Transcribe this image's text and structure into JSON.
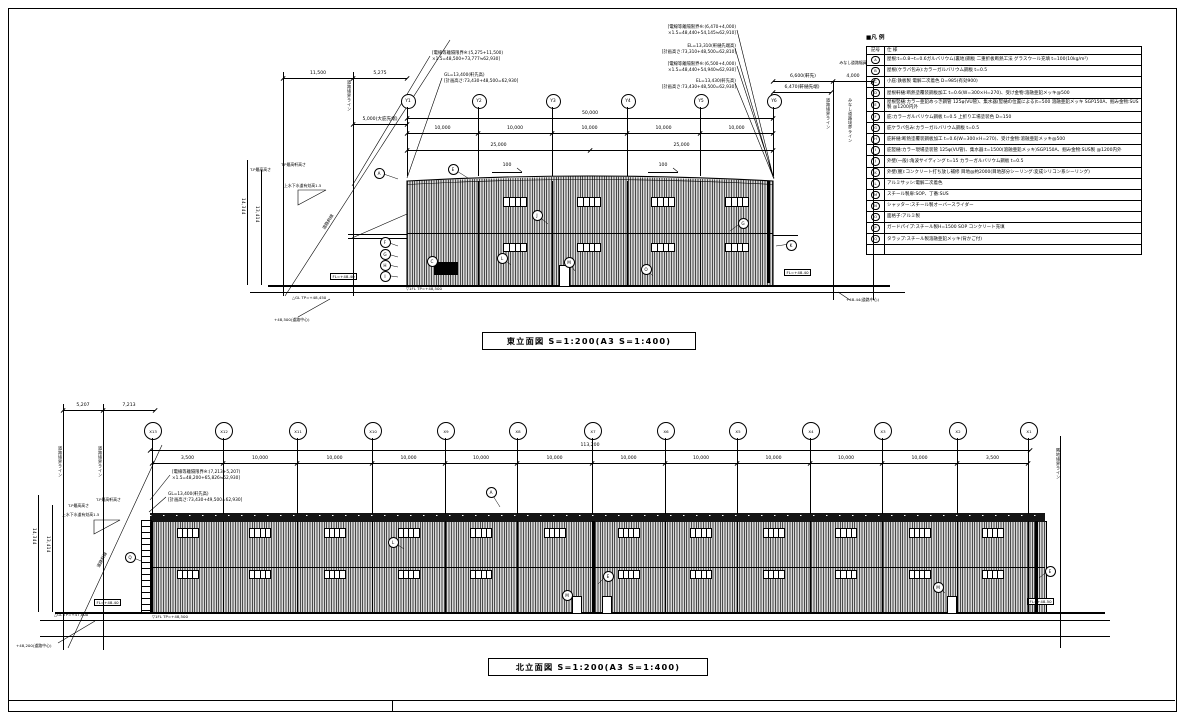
{
  "legend": {
    "title": "■凡 例",
    "col_symbol": "記号",
    "col_spec": "仕  様",
    "rows": [
      {
        "sym": "A",
        "spec": "屋根:t=0.8~t=0.6ガルバリウム(裏地)鋼板 二重折板断熱工法 グラスウール充填 t=100(10kg/m²)"
      },
      {
        "sym": "B",
        "spec": "屋根(ケラバ包み):カラーガルバリウム鋼板 t=0.5"
      },
      {
        "sym": "C",
        "spec": "小庇:鉄板製 電解二次着色 D=985(有効900)"
      },
      {
        "sym": "D",
        "spec": "屋根軒樋:断熱塗覆装鋼板加工 t=0.6(W=300×H=270)、受け金物:溶融亜鉛メッキ@500"
      },
      {
        "sym": "E",
        "spec": "屋根竪樋:カラー亜鉛めっき鋼管 125φ(VU管)、集水器(竪樋の位置による)t=500 溶融亜鉛メッキ SGP150A、掴み金物:SUS製 @1200内外"
      },
      {
        "sym": "F",
        "spec": "庇:カラーガルバリウム鋼板 t=0.5 上折り工場塗装色 D=150"
      },
      {
        "sym": "G",
        "spec": "庇ケラバ包み:カラーガルバリウム鋼板 t=0.5"
      },
      {
        "sym": "H",
        "spec": "庇軒樋:断熱塗覆装鋼板加工 t=0.6(W=300×H=270)、受け金物:溶融亜鉛メッキ@500"
      },
      {
        "sym": "I",
        "spec": "庇竪樋:カラー現場塗装管 125φ(VU管)、集水器:t=1500(溶融亜鉛メッキ)SGP150A、掴み金物:SUS製 @1200内外"
      },
      {
        "sym": "J",
        "spec": "外壁(一般):角波サイディング t=15 カラーガルバリウム鋼板 t=0.5"
      },
      {
        "sym": "K",
        "spec": "外壁(腰):コンクリート打ち放し補修 目地@約2000(目地部分シーリング:変成シリコン系シーリング)"
      },
      {
        "sym": "L",
        "spec": "アルミサッシ:電解二次着色"
      },
      {
        "sym": "M",
        "spec": "スチール製扉:SOP、丁番:SUS"
      },
      {
        "sym": "N",
        "spec": "シャッター:スチール製オーバースライダー"
      },
      {
        "sym": "O",
        "spec": "面格子:アルミ製"
      },
      {
        "sym": "P",
        "spec": "ガードパイプ:スチール製H=1500 SOP コンクリート充填"
      },
      {
        "sym": "Q",
        "spec": "タラップ:スチール製溶融亜鉛メッキ(背かご付)"
      }
    ]
  },
  "east": {
    "title": "東立面図  S=1:200(A3 S=1:400)",
    "grids": [
      "Y1",
      "Y2",
      "Y3",
      "Y4",
      "Y5",
      "Y6"
    ],
    "dims": {
      "overall": "50,000",
      "spans": [
        "10,000",
        "10,000",
        "10,000",
        "10,000",
        "10,000"
      ],
      "halves": [
        "25,000",
        "25,000"
      ],
      "left_offsets": [
        "11,500",
        "5,275"
      ],
      "canopy": "5,000(大庇先端)",
      "right_row1": [
        "6,600(軒先)",
        "4,000"
      ],
      "right_row2": [
        "6,470(軒樋先端)"
      ],
      "deemed_road": "みなし道路幅員",
      "height_outer": "14,344",
      "height_inner": "13,414",
      "slope_mark": "100"
    },
    "notes": {
      "left1": [
        "[電線等離隔限界※:(5,275+11,500)",
        "×1.5=48,500+73,777≒62,930]"
      ],
      "left2": [
        "GL=13,400(軒先高)",
        "[計画高さ:73,430+48,500=62,930]"
      ],
      "right1": [
        "[電線等離隔限界※:(6,470+4,000)",
        "×1.5=48,440+54,145≒62,910]"
      ],
      "right2": [
        "EL=13,310(軒樋先端高)",
        "[計画高さ:73,310+48,500=62,810]"
      ],
      "right3": [
        "[電線等離隔限界※:(6,500+4,000)",
        "×1.5=48,440+54,940≒62,930]"
      ],
      "right4": [
        "EL=13,430(軒先高)",
        "[計画高さ:73,430+48,500=62,930]"
      ]
    },
    "labels": {
      "boundary_left": "道路境界ライン",
      "boundary_right": "道路境界ライン",
      "deemed_boundary": "みなし道路境界ライン",
      "road_slope": "道路斜線",
      "tp_max": "T.P最高高さ",
      "tp_eave": "T.P最高軒高さ",
      "sewer": "上水下水道有効高1.5",
      "fl_box": "FL=+48.40",
      "fl_level": "▽1FL TP=+48,500",
      "gl": "△GL TP=+48,450",
      "road_center_left": "+48,500(道路中心)",
      "road_center_right": "+48.44(道路中心)"
    },
    "callouts": [
      {
        "letter": "A",
        "x": 378,
        "y": 172,
        "dx": 20,
        "dy": 7
      },
      {
        "letter": "E",
        "x": 452,
        "y": 168,
        "dx": 16,
        "dy": 10
      },
      {
        "letter": "J",
        "x": 536,
        "y": 214,
        "dx": 12,
        "dy": 10
      },
      {
        "letter": "G",
        "x": 742,
        "y": 222,
        "dx": -12,
        "dy": 9
      },
      {
        "letter": "L",
        "x": 501,
        "y": 257,
        "dx": 10,
        "dy": 8
      },
      {
        "letter": "C",
        "x": 431,
        "y": 260,
        "dx": 8,
        "dy": 8
      },
      {
        "letter": "M",
        "x": 568,
        "y": 261,
        "dx": 7,
        "dy": 10
      },
      {
        "letter": "O",
        "x": 645,
        "y": 268,
        "dx": 8,
        "dy": 8
      },
      {
        "letter": "K",
        "x": 790,
        "y": 244,
        "dx": -14,
        "dy": 2
      },
      {
        "letter": "F",
        "x": 384,
        "y": 241,
        "dx": 14,
        "dy": 5
      },
      {
        "letter": "G",
        "x": 384,
        "y": 253,
        "dx": 14,
        "dy": 4
      },
      {
        "letter": "H",
        "x": 384,
        "y": 264,
        "dx": 14,
        "dy": 3
      },
      {
        "letter": "I",
        "x": 384,
        "y": 275,
        "dx": 14,
        "dy": 2
      }
    ]
  },
  "north": {
    "title": "北立面図  S=1:200(A3 S=1:400)",
    "grids": [
      "X13",
      "X12",
      "X11",
      "X10",
      "X9",
      "X8",
      "X7",
      "X6",
      "X5",
      "X4",
      "X3",
      "X2",
      "X1"
    ],
    "dims": {
      "overall": "113,200",
      "spans": [
        "3,500",
        "10,000",
        "10,000",
        "10,000",
        "10,000",
        "10,000",
        "10,000",
        "10,000",
        "10,000",
        "10,000",
        "10,000",
        "3,500"
      ],
      "left_offsets": [
        "5,207",
        "7,213"
      ],
      "height_outer": "14,344",
      "height_inner": "13,414"
    },
    "notes": {
      "left1": [
        "[電線等離隔限界※:(7,213+5,207)",
        "×1.5=48,200+65,826≒52,930]"
      ],
      "left2": [
        "GL=13,400(軒先高)",
        "[計画高さ:73,430+49,500=62,930]"
      ]
    },
    "labels": {
      "boundary_left1": "道路境界ライン",
      "boundary_left2": "道路境界ライン",
      "boundary_right": "隣地境界ライン",
      "road_slope": "道路斜線",
      "tp_max": "T.P最高高さ",
      "tp_eave": "T.P最高軒高さ",
      "sewer": "上水下水道有効高1.5",
      "fl_box_left": "FL=+48.40",
      "fl_box_right": "FL=+48.50",
      "fl_level": "▽1FL TP=+48,500",
      "gl": "△GL TP=+47,800",
      "road_center": "+48,200(道路中心)"
    },
    "callouts": [
      {
        "letter": "A",
        "x": 490,
        "y": 491,
        "dx": 10,
        "dy": 16
      },
      {
        "letter": "Q",
        "x": 129,
        "y": 556,
        "dx": 12,
        "dy": 5
      },
      {
        "letter": "L",
        "x": 392,
        "y": 541,
        "dx": 12,
        "dy": 8
      },
      {
        "letter": "E",
        "x": 607,
        "y": 575,
        "dx": -9,
        "dy": 9
      },
      {
        "letter": "M",
        "x": 566,
        "y": 594,
        "dx": 8,
        "dy": 7
      },
      {
        "letter": "M",
        "x": 937,
        "y": 586,
        "dx": 8,
        "dy": 7
      },
      {
        "letter": "E",
        "x": 1049,
        "y": 570,
        "dx": -10,
        "dy": 8
      }
    ]
  }
}
